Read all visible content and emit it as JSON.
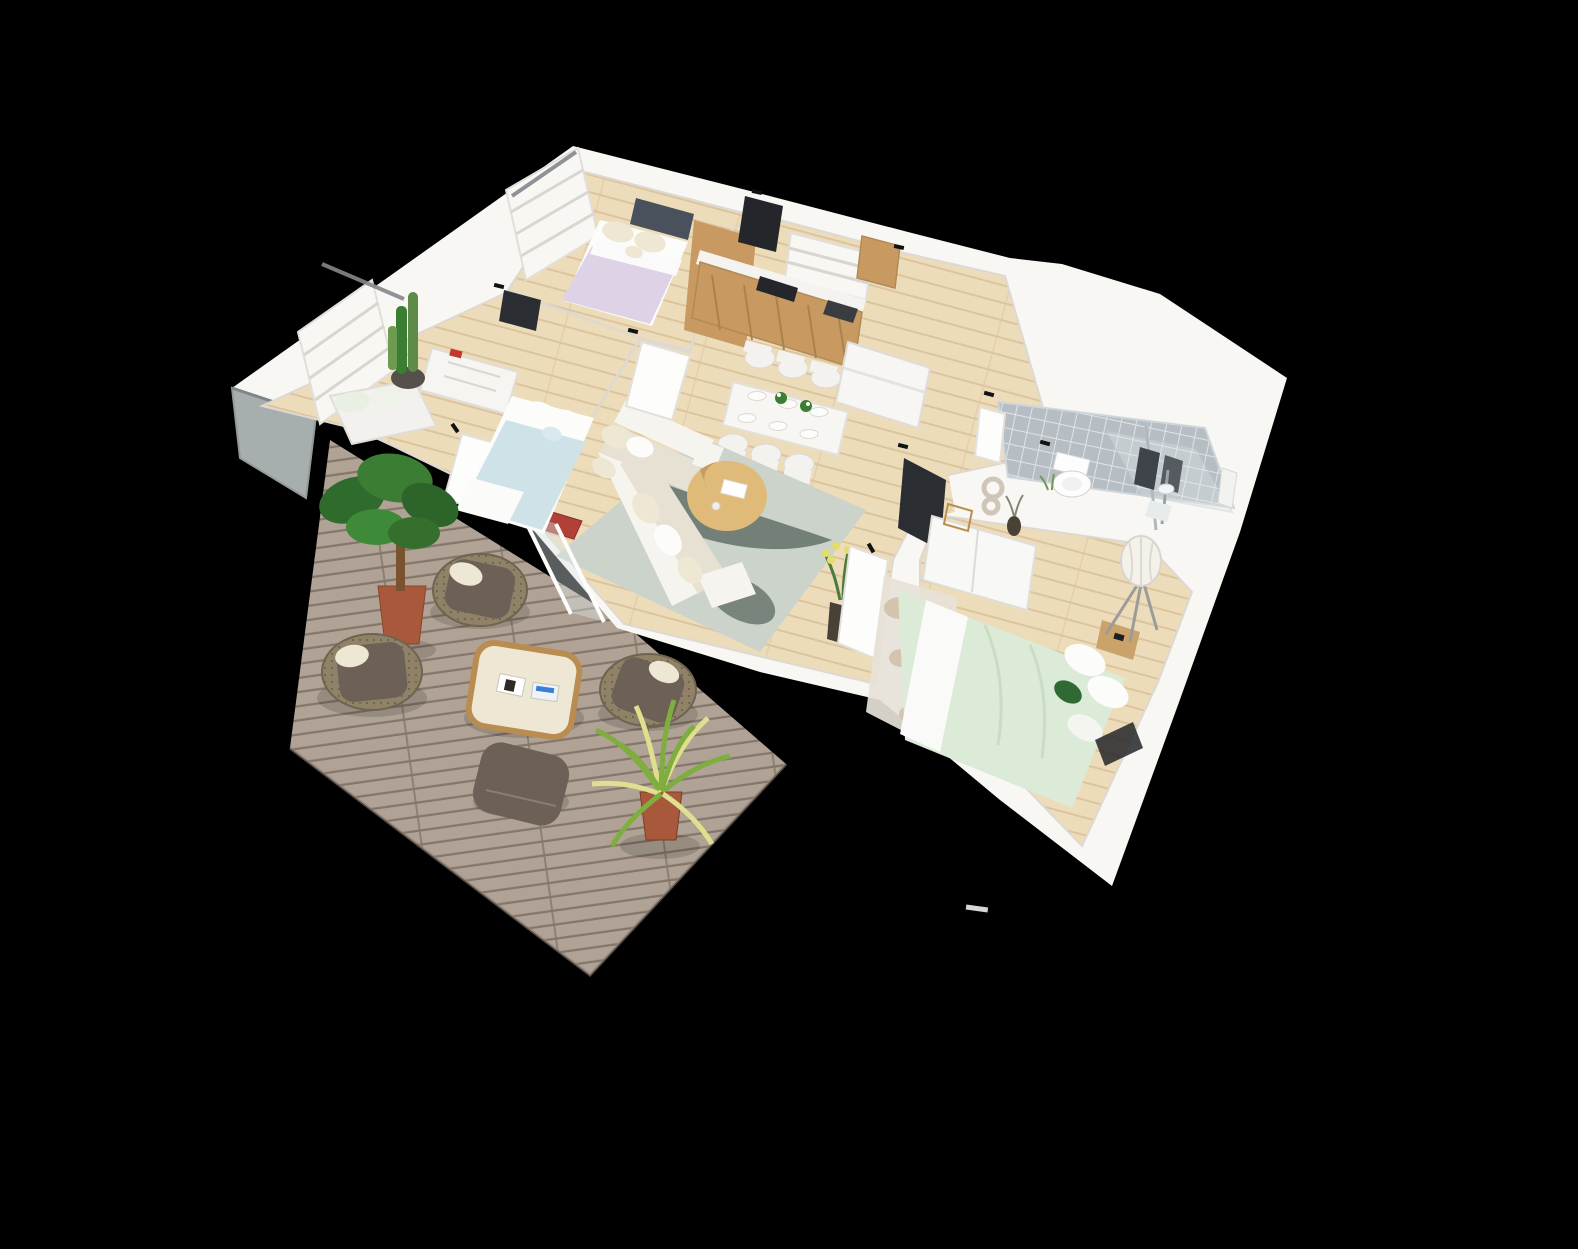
{
  "scene": {
    "kind": "3d-floorplan-render",
    "view": "isometric-cutaway",
    "background": "#000000"
  },
  "palette": {
    "background": "#000000",
    "wall_white": "#f8f7f4",
    "wall_face": "#efeeea",
    "wall_edge": "#d8d5d0",
    "rail_dark": "#83888c",
    "wood_floor": "#eddcba",
    "wood_floor_line": "#dcc49e",
    "deck": "#b0a396",
    "deck_line": "#84766a",
    "tile": "#b6bec4",
    "tile_grout": "#dfe4e8",
    "glass": "#dfe8e8",
    "rug_living": "#ccd3ca",
    "rug_leaf": "#55645b",
    "sofa_white": "#f6f4ee",
    "sofa_shadow": "#e6e1d2",
    "cushion_cream": "#eee7d3",
    "coffee_table": "#e0ba79",
    "table_white": "#f7f6f3",
    "chair_white": "#f3f2ef",
    "kitchen_wood": "#c89a62",
    "kitchen_dark": "#24262b",
    "counter_white": "#f4f3ef",
    "appliance_dark": "#3a3d40",
    "bed_lilac": "#ddd2e6",
    "headboard_slate": "#49525c",
    "bed_blue": "#cfe2e8",
    "bed_mint": "#dcead8",
    "pillow_white": "#fcfcfa",
    "accent_green": "#2f6a34",
    "terracotta": "#a8583b",
    "pot_dark": "#56504a",
    "plant_green": "#3b7d33",
    "plant_light": "#7fae3f",
    "plant_stripe": "#dfdf90",
    "wicker": "#8f8266",
    "cushion_brown": "#6d6057",
    "pebble_beige": "#d4c4ae",
    "pebble_gray": "#a8aaa4",
    "towel_gray": "#565b61",
    "towel_dark": "#3f444a",
    "tv_dark": "#2a2e33",
    "mat_red": "#b04038",
    "flower_yellow": "#e3dd6e",
    "lamp_shade": "#f3f1ea",
    "wood_side": "#caa36a",
    "sculpture_bone": "#cfc6b8",
    "frame_gold": "#d9b36a",
    "vase_dark": "#4a4136"
  },
  "rooms": [
    {
      "id": "bedroom-top",
      "floor": "wood_floor"
    },
    {
      "id": "bedroom-left",
      "floor": "wood_floor"
    },
    {
      "id": "living-dining",
      "floor": "wood_floor"
    },
    {
      "id": "kitchen",
      "floor": "wood_floor"
    },
    {
      "id": "hallway",
      "floor": "wood_floor"
    },
    {
      "id": "bathroom",
      "floor": "tile"
    },
    {
      "id": "master-bedroom",
      "floor": "wood_floor"
    },
    {
      "id": "terrace",
      "floor": "deck"
    }
  ],
  "furniture": {
    "bedroom_top": [
      "double-bed-lilac",
      "slate-headboard",
      "cream-pillows",
      "roman-shade-window"
    ],
    "bedroom_left": [
      "double-bed-blue",
      "white-dresser",
      "daybed",
      "cactus-plant",
      "wall-tv",
      "roman-shade-window"
    ],
    "kitchen": [
      "tall-oven-column",
      "corner-extractor-hood",
      "wood-counter",
      "gas-hob",
      "sink",
      "wall-cabinet",
      "roman-shade-window"
    ],
    "dining": [
      "white-table",
      "six-white-chairs",
      "place-settings",
      "flower-centerpieces"
    ],
    "living": [
      "l-shaped-white-sofa",
      "round-wood-coffee-table",
      "gray-leaf-rug",
      "yellow-flower-pot",
      "red-doormat",
      "wall-tv",
      "glass-sliding-doors"
    ],
    "hallway": [
      "white-bench"
    ],
    "bathroom": [
      "toilet",
      "walk-in-shower",
      "glass-panel",
      "gray-towels",
      "towel-bar"
    ],
    "master_bedroom": [
      "double-bed-mint",
      "white-sideboard",
      "figure-eight-sculpture",
      "gold-frame",
      "dark-vase",
      "pebble-rug",
      "tripod-floor-lamp",
      "nightstand"
    ],
    "terrace": [
      "plank-deck",
      "three-wicker-armchairs",
      "square-coffee-table",
      "magazines",
      "ottoman",
      "spider-plant",
      "potted-tree"
    ]
  }
}
